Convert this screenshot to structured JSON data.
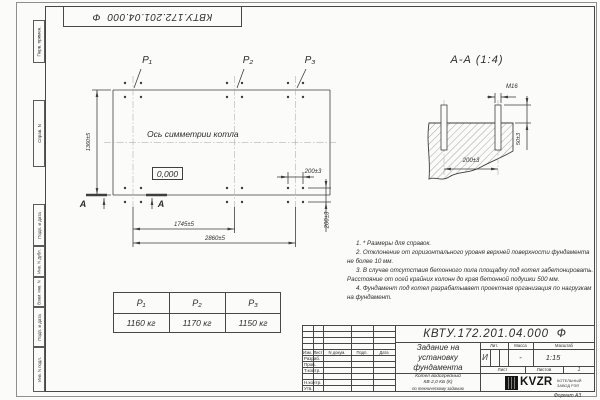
{
  "corner_designation": "КВТУ.172.201.04.000  Ф",
  "margin_labels": [
    "Перв. примен.",
    "Справ. N",
    "Подп. и дата",
    "Инв. N дубл.",
    "Взам. инв. N",
    "Подп. и дата",
    "Инв. N подл."
  ],
  "plan": {
    "load_p1": "P₁",
    "load_p2": "P₂",
    "load_p3": "P₃",
    "symmetry_axis_label": "Ось симметрии котла",
    "elevation_mark": "0,000",
    "dim_height": "1360±5",
    "dim_span_mid": "1745±5",
    "dim_span_total": "2860±5",
    "dim_group_h": "200±3",
    "dim_group_v": "200±3",
    "cut_letter": "А"
  },
  "section_view": {
    "title": "А-А (1:4)",
    "bolt_label": "М16",
    "dim_protrusion": "50±3",
    "dim_spacing": "200±3"
  },
  "notes": [
    "1. * Размеры для справок.",
    "2. Отклонение от горизонтального уровня верхней поверхности фундамента не более 10 мм.",
    "3. В случае отсутствия бетонного пола площадку под котел забетонировать. Расстояние от осей крайних колонн до края бетонной подушки 500 мм.",
    "4. Фундамент под котел разрабатывает проектная организация по нагрузкам на фундамент."
  ],
  "load_table": {
    "headers": [
      "P₁",
      "P₂",
      "P₃"
    ],
    "values": [
      "1160 кг",
      "1170 кг",
      "1150 кг"
    ]
  },
  "title_block": {
    "designation": "КВТУ.172.201.04.000  Ф",
    "title_lines": [
      "Задание на",
      "установку",
      "фундамента"
    ],
    "product_lines": [
      "Котел водогрейный",
      "КВ-2,0 КБ (К)",
      "по техническому заданию"
    ],
    "rev_headers": [
      "Изм.",
      "Лист",
      "N докум.",
      "Подп.",
      "Дата"
    ],
    "sig_rows": [
      "Разраб.",
      "Пров.",
      "Т.контр.",
      "",
      "Н.контр.",
      "Утв."
    ],
    "lit_header": "Лит.",
    "mass_header": "Масса",
    "scale_header": "Масштаб",
    "lit_value": "И",
    "mass_value": "-",
    "scale_value": "1:15",
    "sheet_label": "Лист",
    "sheets_label": "Листов",
    "sheets_value": "1",
    "logo_text": "KVZR",
    "logo_caption_lines": [
      "КОТЕЛЬНЫЙ",
      "ЗАВОД РЭП"
    ],
    "format_label": "Формат А3"
  },
  "colors": {
    "line": "#3f3f3f",
    "accent_dark": "#151515",
    "paper": "#fbfbfa"
  }
}
